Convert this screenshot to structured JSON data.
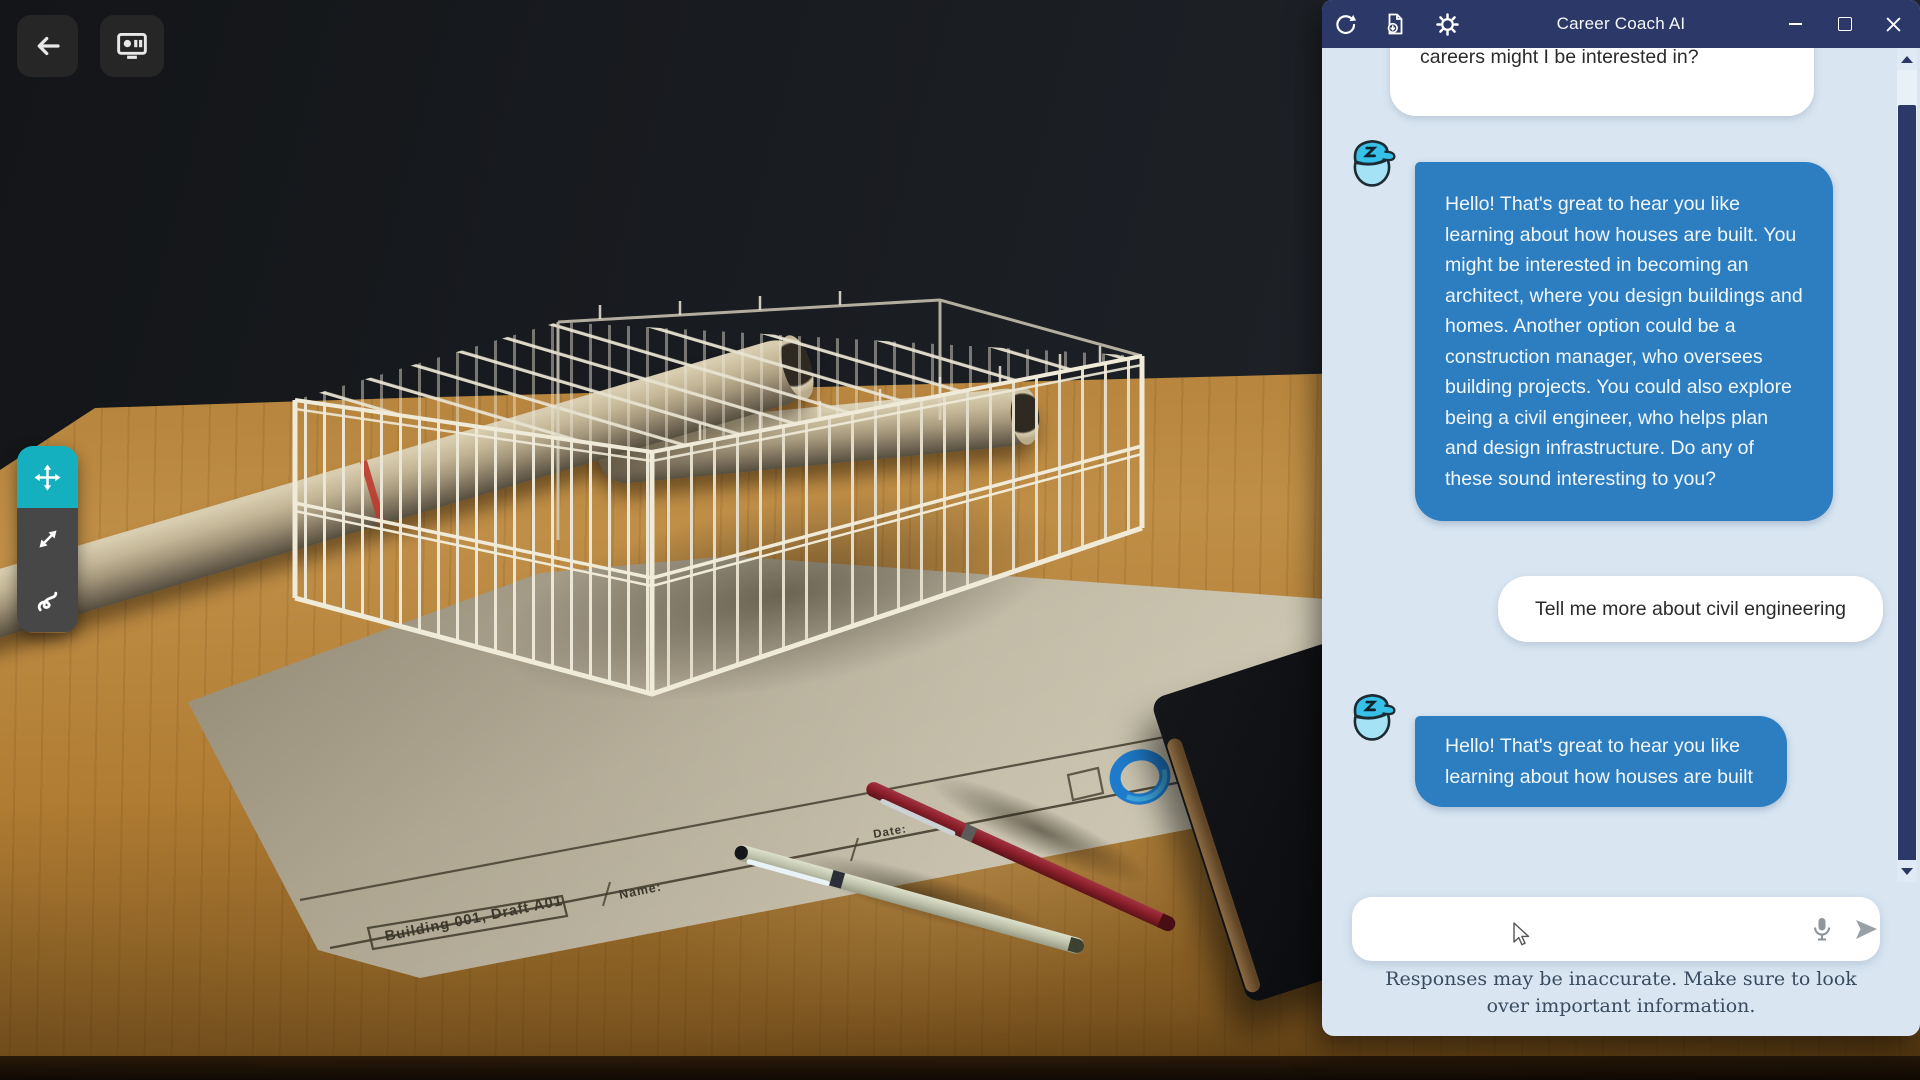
{
  "scene": {
    "back_button": {
      "icon": "back-arrow-icon"
    },
    "screen_share_button": {
      "icon": "screen-share-icon"
    },
    "transform_toolbar": {
      "active_color": "#14b0c0",
      "tools": [
        {
          "id": "move",
          "icon": "move-icon",
          "active": true
        },
        {
          "id": "scale",
          "icon": "scale-icon",
          "active": false
        },
        {
          "id": "draw",
          "icon": "draw-icon",
          "active": false
        }
      ]
    },
    "paper": {
      "title_block": "Building 001, Draft A01",
      "name_label": "Name:",
      "date_label": "Date:",
      "brand_text": "pace"
    }
  },
  "chat_window": {
    "title": "Career Coach AI",
    "titlebar_icons": [
      "sync-icon",
      "export-document-icon",
      "settings-gear-icon"
    ],
    "window_controls": [
      "minimize",
      "maximize",
      "close"
    ],
    "conversation": [
      {
        "role": "user",
        "text": "careers might I be interested in?"
      },
      {
        "role": "assistant",
        "text": "Hello! That's great to hear you like learning about how houses are built. You might be interested in becoming an architect, where you design buildings and homes. Another option could be a construction manager, who oversees building projects. You could also explore being a civil engineer, who helps plan and design infrastructure. Do any of these sound interesting to you?"
      },
      {
        "role": "user",
        "text": "Tell me more about civil engineering"
      },
      {
        "role": "assistant",
        "text": "Hello! That's great to hear you like learning about how houses are built"
      }
    ],
    "composer": {
      "value": "",
      "mic_icon": "microphone-icon",
      "send_icon": "send-icon"
    },
    "disclaimer": "Responses may be inaccurate. Make sure to look over important information.",
    "colors": {
      "titlebar": "#2c3968",
      "panel_bg": "#d9e6f2",
      "assistant_bubble": "#2d7ec1",
      "user_bubble": "#ffffff",
      "scrollbar_thumb": "#2c3968"
    }
  }
}
